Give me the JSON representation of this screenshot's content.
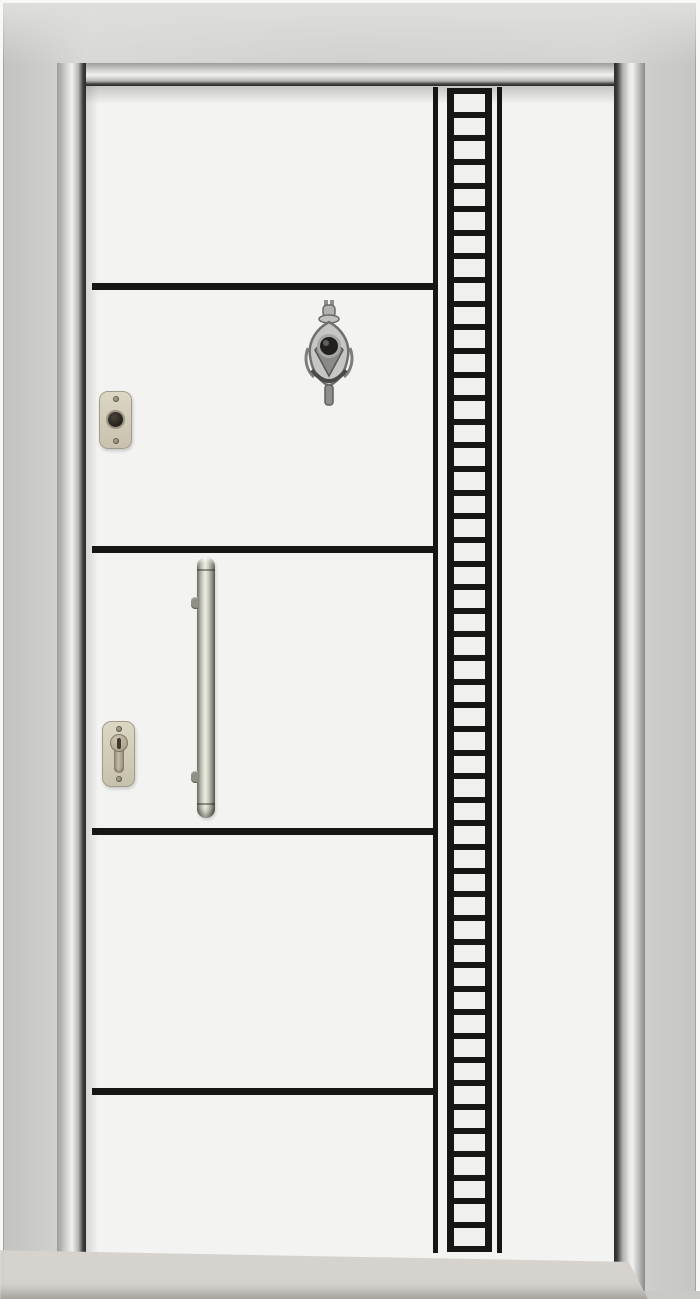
{
  "meta": {
    "type": "photograph",
    "subject": "White steel security door in a silver-grey frame, flat white leaf with four horizontal black grooves, a vertical black ladder inlay on the right, silver door viewer knocker, beige lock cylinders, long vertical pull handle, terrazzo threshold at the bottom",
    "visible_text": "none"
  },
  "colors": {
    "mat": "#f8f8f7",
    "frame": "#cfcfcd",
    "frame_edge": "#a3a3a1",
    "molding_light": "#f1f1ef",
    "molding_dark": "#8a8a88",
    "gap_line": "#2c2c2a",
    "leaf": "#f3f3f1",
    "groove_black": "#161614",
    "ladder_cell": "#f0f0ee",
    "knocker_silver": "#c2c2c0",
    "peephole": "#23211f",
    "lock_plate_beige": "#d2ccba",
    "keyhole": "#3f3a2f",
    "handle_steel": "#edeee2",
    "floor_terrazzo": "#d6d3ce",
    "speckle": "#3b3834"
  },
  "door": {
    "grooves": {
      "horizontal_count": 4,
      "vertical_count": 2
    },
    "ladder": {
      "rung_count": 50,
      "rails": 2
    },
    "hardware": [
      {
        "name": "door-knocker-peephole",
        "finish": "silver"
      },
      {
        "name": "deadbolt-cylinder-plate",
        "finish": "beige"
      },
      {
        "name": "key-cylinder-plate",
        "finish": "beige"
      },
      {
        "name": "vertical-pull-handle",
        "finish": "stainless"
      }
    ],
    "threshold": {
      "material": "terrazzo"
    }
  }
}
